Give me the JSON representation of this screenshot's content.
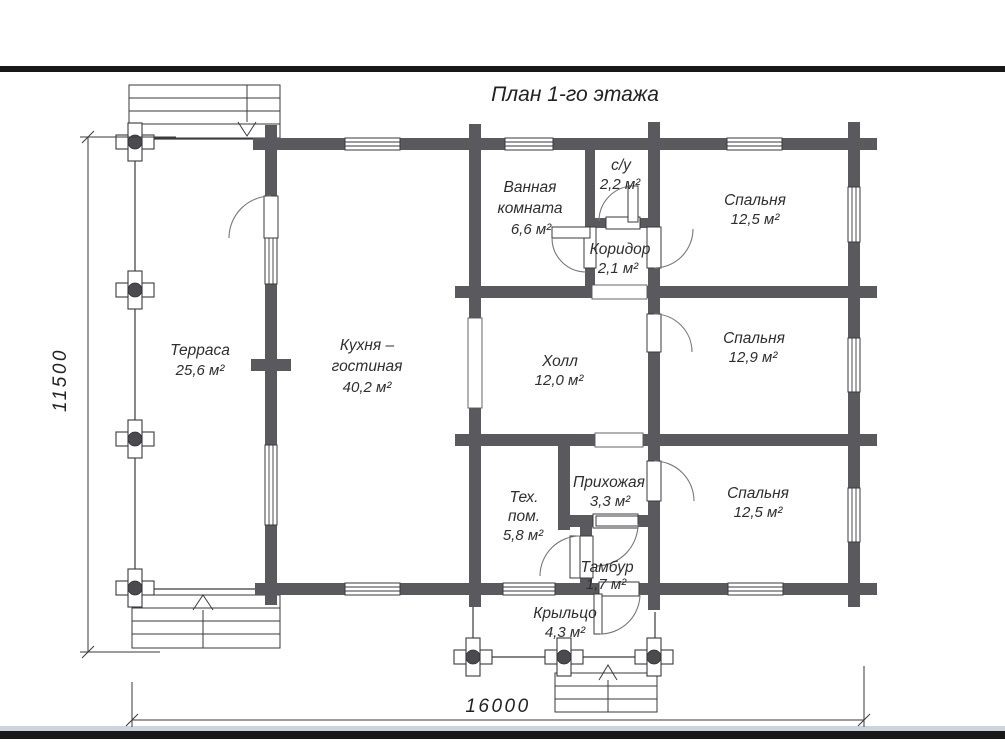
{
  "page": {
    "title": "План 1-го этажа"
  },
  "plan": {
    "rooms": {
      "terrace": {
        "name": "Терраса",
        "area": "25,6 м²"
      },
      "kitchen_living": {
        "name_line1": "Кухня –",
        "name_line2": "гостиная",
        "area": "40,2 м²"
      },
      "bathroom": {
        "name_line1": "Ванная",
        "name_line2": "комната",
        "area": "6,6 м²"
      },
      "wc": {
        "name": "с/у",
        "area": "2,2 м²"
      },
      "corridor": {
        "name": "Коридор",
        "area": "2,1 м²"
      },
      "bedroom_top": {
        "name": "Спальня",
        "area": "12,5 м²"
      },
      "hall": {
        "name": "Холл",
        "area": "12,0 м²"
      },
      "bedroom_middle": {
        "name": "Спальня",
        "area": "12,9 м²"
      },
      "tech_room": {
        "name_line1": "Тех.",
        "name_line2": "пом.",
        "area": "5,8 м²"
      },
      "entry_hall": {
        "name": "Прихожая",
        "area": "3,3 м²"
      },
      "bedroom_bottom": {
        "name": "Спальня",
        "area": "12,5 м²"
      },
      "tambour": {
        "name": "Тамбур",
        "area": "1,7 м²"
      },
      "porch": {
        "name": "Крыльцо",
        "area": "4,3 м²"
      }
    },
    "dimensions": {
      "height": "11500",
      "width": "16000"
    },
    "colors": {
      "wall": "#5a5a5e",
      "line": "#3a3a3e",
      "text": "#2e2e30"
    }
  }
}
